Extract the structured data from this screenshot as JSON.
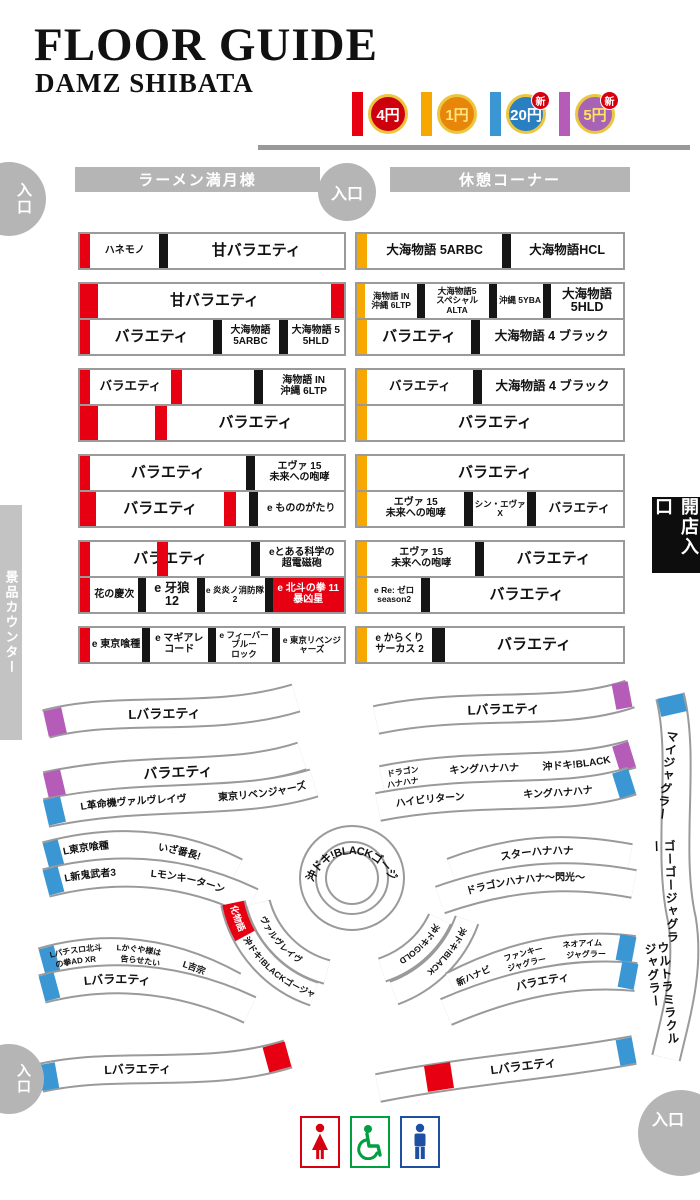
{
  "header": {
    "title": "FLOOR GUIDE",
    "subtitle": "DAMZ SHIBATA"
  },
  "legend": {
    "items": [
      {
        "bar": "#e60012",
        "coin_bg": "#cf000e",
        "coin_fg": "#ffffff",
        "label": "4円",
        "new_badge": ""
      },
      {
        "bar": "#f6a800",
        "coin_bg": "#e8860a",
        "coin_fg": "#ffe480",
        "label": "1円",
        "new_badge": ""
      },
      {
        "bar": "#3b97d3",
        "coin_bg": "#2a7fc0",
        "coin_fg": "#ffffff",
        "label": "20円",
        "new_badge": "新"
      },
      {
        "bar": "#b45cb8",
        "coin_bg": "#a763b5",
        "coin_fg": "#ffe45c",
        "label": "5円",
        "new_badge": "新"
      }
    ]
  },
  "zones": {
    "ramen": "ラーメン満月様",
    "rest": "休憩コーナー",
    "prize": "景品カウンター",
    "open": "開店入口"
  },
  "entrances": {
    "top_left": "入口",
    "top_mid": "入口",
    "bottom_left": "入口",
    "bottom_right": "入口"
  },
  "jagglers": [
    "マイジャグラー",
    "ゴーゴージャグラー",
    "ウルトラミラクルジャグラー"
  ],
  "restroom_icons": [
    "woman-icon",
    "wheelchair-icon",
    "man-icon"
  ],
  "grid": {
    "left": [
      {
        "rows": [
          [
            {
              "bar": "#e60012",
              "px": 10
            },
            {
              "t": "ハネモノ",
              "sz": "s",
              "w": 0.95
            },
            {
              "blk": 9
            },
            {
              "t": "甘バラエティ",
              "sz": "l",
              "w": 2.4
            }
          ]
        ]
      },
      {
        "rows": [
          [
            {
              "bar": "#e60012",
              "px": 18
            },
            {
              "t": "甘バラエティ",
              "sz": "l",
              "w": 1
            },
            {
              "bar": "#e60012",
              "px": 13
            }
          ],
          [
            {
              "bar": "#e60012",
              "px": 10
            },
            {
              "t": "バラエティ",
              "sz": "l",
              "w": 1.75
            },
            {
              "blk": 9
            },
            {
              "t": "大海物語\n5ARBC",
              "sz": "s",
              "w": 0.8
            },
            {
              "blk": 9
            },
            {
              "t": "大海物語 5\n5HLD",
              "sz": "s",
              "w": 0.8
            }
          ]
        ]
      },
      {
        "rows": [
          [
            {
              "bar": "#e60012",
              "px": 10
            },
            {
              "t": "バラエティ",
              "sz": "m",
              "w": 1
            },
            {
              "bar": "#e60012",
              "px": 11
            },
            {
              "t": "",
              "sz": "m",
              "w": 0.9
            },
            {
              "blk": 9
            },
            {
              "t": "海物語 IN\n沖縄 6LTP",
              "sz": "s",
              "w": 1
            }
          ],
          [
            {
              "bar": "#e60012",
              "px": 18
            },
            {
              "t": "",
              "sz": "m",
              "w": 0.55
            },
            {
              "bar": "#e60012",
              "px": 12
            },
            {
              "t": "バラエティ",
              "sz": "l",
              "w": 1.7
            }
          ]
        ]
      },
      {
        "rows": [
          [
            {
              "bar": "#e60012",
              "px": 10
            },
            {
              "t": "バラエティ",
              "sz": "l",
              "w": 1.75
            },
            {
              "blk": 9
            },
            {
              "t": "エヴァ 15\n未来への咆哮",
              "sz": "s",
              "w": 1
            }
          ],
          [
            {
              "bar": "#e60012",
              "px": 16
            },
            {
              "t": "バラエティ",
              "sz": "l",
              "w": 1.5
            },
            {
              "bar": "#e60012",
              "px": 12
            },
            {
              "t": "",
              "sz": "m",
              "w": 0.15
            },
            {
              "blk": 9
            },
            {
              "t": "e もののがたり",
              "sz": "s",
              "w": 1
            }
          ]
        ]
      },
      {
        "rows": [
          [
            {
              "bar": "#e60012",
              "px": 10
            },
            {
              "t": "バラエティ",
              "sz": "l",
              "w": 1.9,
              "stripe": 42
            },
            {
              "blk": 9
            },
            {
              "t": "eとある科学の\n超電磁砲",
              "sz": "s",
              "w": 1
            }
          ],
          [
            {
              "bar": "#e60012",
              "px": 10
            },
            {
              "t": "花の慶次",
              "sz": "s",
              "w": 0.78
            },
            {
              "blk": 8
            },
            {
              "t": "e 牙狼 12",
              "sz": "m",
              "w": 0.82
            },
            {
              "blk": 8
            },
            {
              "t": "e 炎炎ノ消防隊 2",
              "sz": "t",
              "w": 0.95
            },
            {
              "blk": 8
            },
            {
              "t": "e 北斗の拳 11\n暴凶星",
              "sz": "s",
              "w": 1.15,
              "red": true
            }
          ]
        ]
      },
      {
        "rows": [
          [
            {
              "bar": "#e60012",
              "px": 10
            },
            {
              "t": "e 東京喰種",
              "sz": "s",
              "w": 0.85
            },
            {
              "blk": 8
            },
            {
              "t": "e マギアレコード",
              "sz": "s",
              "w": 0.95
            },
            {
              "blk": 8
            },
            {
              "t": "e フィーバーブルー\nロック",
              "sz": "t",
              "w": 0.9
            },
            {
              "blk": 8
            },
            {
              "t": "e 東京リベンジャーズ",
              "sz": "t",
              "w": 1.05
            }
          ]
        ]
      }
    ],
    "right": [
      {
        "rows": [
          [
            {
              "bar": "#f6a800",
              "px": 10
            },
            {
              "t": "大海物語 5ARBC",
              "sz": "m",
              "w": 1.15
            },
            {
              "blk": 9
            },
            {
              "t": "大海物語HCL",
              "sz": "m",
              "w": 0.95
            }
          ]
        ]
      },
      {
        "rows": [
          [
            {
              "bar": "#f6a800",
              "px": 8
            },
            {
              "t": "海物語 IN\n沖縄 6LTP",
              "sz": "t",
              "w": 0.62
            },
            {
              "blk": 8
            },
            {
              "t": "大海物語5\nスペシャル ALTA",
              "sz": "t",
              "w": 0.75
            },
            {
              "blk": 8
            },
            {
              "t": "沖縄 5YBA",
              "sz": "t",
              "w": 0.55
            },
            {
              "blk": 8
            },
            {
              "t": "大海物語\n5HLD",
              "sz": "m",
              "w": 0.85
            }
          ],
          [
            {
              "bar": "#f6a800",
              "px": 10
            },
            {
              "t": "バラエティ",
              "sz": "l",
              "w": 0.95
            },
            {
              "blk": 9
            },
            {
              "t": "大海物語 4 ブラック",
              "sz": "m",
              "w": 1.3
            }
          ]
        ]
      },
      {
        "rows": [
          [
            {
              "bar": "#f6a800",
              "px": 10
            },
            {
              "t": "バラエティ",
              "sz": "m",
              "w": 0.9
            },
            {
              "blk": 9
            },
            {
              "t": "大海物語 4 ブラック",
              "sz": "m",
              "w": 1.2
            }
          ],
          [
            {
              "bar": "#f6a800",
              "px": 10
            },
            {
              "t": "バラエティ",
              "sz": "l",
              "w": 1
            }
          ]
        ]
      },
      {
        "rows": [
          [
            {
              "bar": "#f6a800",
              "px": 10
            },
            {
              "t": "バラエティ",
              "sz": "l",
              "w": 1
            }
          ],
          [
            {
              "bar": "#f6a800",
              "px": 10
            },
            {
              "t": "エヴァ 15\n未来への咆哮",
              "sz": "s",
              "w": 0.95
            },
            {
              "blk": 9
            },
            {
              "t": "シン・エヴァ X",
              "sz": "t",
              "w": 0.52
            },
            {
              "blk": 9
            },
            {
              "t": "バラエティ",
              "sz": "m",
              "w": 0.85
            }
          ]
        ]
      },
      {
        "rows": [
          [
            {
              "bar": "#f6a800",
              "px": 10
            },
            {
              "t": "エヴァ 15\n未来への咆哮",
              "sz": "s",
              "w": 0.9
            },
            {
              "blk": 9
            },
            {
              "t": "バラエティ",
              "sz": "l",
              "w": 1.15
            }
          ],
          [
            {
              "bar": "#f6a800",
              "px": 10
            },
            {
              "t": "e Re: ゼロ\nseason2",
              "sz": "t",
              "w": 0.45
            },
            {
              "blk": 9
            },
            {
              "t": "バラエティ",
              "sz": "l",
              "w": 1.6
            }
          ]
        ]
      },
      {
        "rows": [
          [
            {
              "bar": "#f6a800",
              "px": 10
            },
            {
              "t": "e からくり\nサーカス 2",
              "sz": "s",
              "w": 0.55
            },
            {
              "blk": 13
            },
            {
              "t": "バラエティ",
              "sz": "l",
              "w": 1.5
            }
          ]
        ]
      }
    ]
  },
  "bands": [
    {
      "id": "bl1",
      "d": "M46,44 C120,24 210,44 296,18",
      "w": 26,
      "caps": [
        {
          "d": "M46,44 L64,40",
          "c": "#b45cb8"
        }
      ],
      "labels": [
        {
          "t": "Lバラエティ",
          "off": "33%",
          "s": 13
        }
      ]
    },
    {
      "id": "br1",
      "d": "M376,40 C470,20 560,38 630,14",
      "w": 26,
      "caps": [
        {
          "d": "M614,17 L630,14",
          "c": "#b45cb8"
        }
      ],
      "labels": [
        {
          "t": "Lバラエティ",
          "off": "36%",
          "s": 13
        }
      ]
    },
    {
      "id": "bl2a",
      "d": "M46,106 C150,84 230,100 302,76",
      "w": 26,
      "caps": [
        {
          "d": "M46,106 L63,102",
          "c": "#b45cb8"
        }
      ],
      "labels": [
        {
          "t": "バラエティ",
          "off": "38%",
          "s": 14
        }
      ]
    },
    {
      "id": "bl2b",
      "d": "M46,133 C150,111 235,127 314,103",
      "w": 26,
      "caps": [
        {
          "d": "M46,133 L63,129",
          "c": "#3b97d3"
        }
      ],
      "labels": [
        {
          "t": "L革命機ヴァルヴレイヴ",
          "off": "13%",
          "s": 10
        },
        {
          "t": "東京リベンジャーズ",
          "off": "64%",
          "s": 10
        }
      ]
    },
    {
      "id": "br2a",
      "d": "M382,100 C480,80 560,96 632,74",
      "w": 26,
      "caps": [
        {
          "d": "M616,79 L632,74",
          "c": "#b45cb8"
        }
      ],
      "labels": [
        {
          "t": "キングハナハナ",
          "off": "27%",
          "s": 10
        },
        {
          "t": "沖ドキ!BLACK",
          "off": "64%",
          "s": 10
        }
      ]
    },
    {
      "id": "br2a1",
      "d": "M382,95 C480,75 560,91 632,69",
      "w": 0,
      "labels": [
        {
          "t": "ドラゴン",
          "off": "2%",
          "s": 8
        }
      ]
    },
    {
      "id": "br2a2",
      "d": "M382,106 C480,86 560,102 632,80",
      "w": 0,
      "labels": [
        {
          "t": "ハナハナ",
          "off": "2%",
          "s": 8
        }
      ]
    },
    {
      "id": "br2b",
      "d": "M378,127 C480,107 565,123 632,101",
      "w": 26,
      "caps": [
        {
          "d": "M616,106 L632,101",
          "c": "#3b97d3"
        }
      ],
      "labels": [
        {
          "t": "ハイビリターン",
          "off": "7%",
          "s": 10
        },
        {
          "t": "キングハナハナ",
          "off": "57%",
          "s": 10
        }
      ]
    },
    {
      "id": "bl3a",
      "d": "M46,176 Q150,148 236,192",
      "w": 26,
      "caps": [
        {
          "d": "M46,176 L61,172",
          "c": "#3b97d3"
        }
      ],
      "labels": [
        {
          "t": "L東京喰種",
          "off": "9%",
          "s": 10
        },
        {
          "t": "いざ番長!",
          "off": "58%",
          "s": 10
        }
      ]
    },
    {
      "id": "bl3b",
      "d": "M46,203 Q155,175 252,222",
      "w": 26,
      "caps": [
        {
          "d": "M46,203 L61,199",
          "c": "#3b97d3"
        }
      ],
      "labels": [
        {
          "t": "L新鬼武者3",
          "off": "9%",
          "s": 10
        },
        {
          "t": "Lモンキーターン",
          "off": "50%",
          "s": 10
        }
      ]
    },
    {
      "id": "br3a",
      "d": "M452,192 C520,166 575,168 630,178",
      "w": 26,
      "labels": [
        {
          "t": "スターハナハナ",
          "off": "28%",
          "s": 10.5
        }
      ]
    },
    {
      "id": "br3b",
      "d": "M440,220 C520,192 580,194 634,204",
      "w": 26,
      "labels": [
        {
          "t": "ドラゴンハナハナ〜閃光〜",
          "off": "14%",
          "s": 10
        }
      ]
    },
    {
      "id": "ringtext",
      "d": "M310,202 A44,44 0 0 1 394,202",
      "w": 0,
      "labels": [
        {
          "t": "沖ドキ!BLACKゴージャス",
          "off": "1%",
          "s": 11
        }
      ]
    },
    {
      "id": "swo",
      "d": "M233,223 A122,122 0 0 0 314,314",
      "w": 22,
      "caps": [
        {
          "d": "M233,223 A122,122 0 0 0 245,256",
          "c": "#e60012"
        }
      ],
      "labels": [
        {
          "t": "化物語",
          "off": "2%",
          "s": 9,
          "fill": "#fff"
        },
        {
          "t": "沖ドキ!BLACKゴージャス",
          "off": "29%",
          "s": 8.5
        }
      ]
    },
    {
      "id": "swi",
      "d": "M258,223 A97,97 0 0 0 327,292",
      "w": 22,
      "labels": [
        {
          "t": "ヴァルヴレイヴ",
          "off": "14%",
          "s": 8.5
        }
      ]
    },
    {
      "id": "seo",
      "d": "M467,240 A122,122 0 0 1 394,313",
      "w": 22,
      "labels": [
        {
          "t": "沖ドキ!BLACK",
          "off": "8%",
          "s": 8.5
        }
      ]
    },
    {
      "id": "sei",
      "d": "M440,239 A97,97 0 0 1 382,290",
      "w": 22,
      "labels": [
        {
          "t": "沖ドキ!GOLD",
          "off": "8%",
          "s": 8.5
        }
      ]
    },
    {
      "id": "bbla",
      "d": "M42,282 Q140,254 234,306",
      "w": 26,
      "caps": [
        {
          "d": "M42,282 L57,278",
          "c": "#3b97d3"
        }
      ],
      "labels": [
        {
          "t": "L吉宗",
          "off": "72%",
          "s": 9
        }
      ]
    },
    {
      "id": "bbla1",
      "d": "M42,277 Q140,249 234,301",
      "w": 0,
      "labels": [
        {
          "t": "Lパチスロ北斗",
          "off": "4%",
          "s": 8
        },
        {
          "t": "Lかぐや様は",
          "off": "38%",
          "s": 8
        }
      ]
    },
    {
      "id": "bbla2",
      "d": "M42,288 Q140,260 234,312",
      "w": 0,
      "labels": [
        {
          "t": "の拳AD XR",
          "off": "7%",
          "s": 8
        },
        {
          "t": "告らせたい",
          "off": "40%",
          "s": 8
        }
      ]
    },
    {
      "id": "bblb",
      "d": "M42,309 Q148,282 250,330",
      "w": 26,
      "caps": [
        {
          "d": "M42,309 L57,305",
          "c": "#3b97d3"
        }
      ],
      "labels": [
        {
          "t": "Lバラエティ",
          "off": "20%",
          "s": 12
        }
      ]
    },
    {
      "id": "bbra",
      "d": "M452,306 Q545,258 634,270",
      "w": 26,
      "caps": [
        {
          "d": "M618,267 L634,270",
          "c": "#3b97d3"
        }
      ],
      "labels": [
        {
          "t": "新ハナビ",
          "off": "3%",
          "s": 9
        }
      ]
    },
    {
      "id": "bbra1",
      "d": "M452,301 Q545,253 634,265",
      "w": 0,
      "labels": [
        {
          "t": "ファンキー",
          "off": "30%",
          "s": 8
        },
        {
          "t": "ネオアイム",
          "off": "62%",
          "s": 8
        }
      ]
    },
    {
      "id": "bbra2",
      "d": "M452,312 Q545,264 634,276",
      "w": 0,
      "labels": [
        {
          "t": "ジャグラー",
          "off": "32%",
          "s": 8
        },
        {
          "t": "ジャグラー",
          "off": "64%",
          "s": 8
        }
      ]
    },
    {
      "id": "bbrb",
      "d": "M446,332 Q548,288 636,297",
      "w": 26,
      "caps": [
        {
          "d": "M620,294 L636,297",
          "c": "#3b97d3"
        }
      ],
      "labels": [
        {
          "t": "バラエティ",
          "off": "38%",
          "s": 11
        }
      ]
    },
    {
      "id": "bsl",
      "d": "M40,398 C120,380 205,400 288,374",
      "w": 26,
      "caps": [
        {
          "d": "M40,398 L57,395",
          "c": "#3b97d3"
        },
        {
          "d": "M266,380 L288,374",
          "c": "#e60012"
        }
      ],
      "labels": [
        {
          "t": "Lバラエティ",
          "off": "26%",
          "s": 12
        }
      ]
    },
    {
      "id": "bsr",
      "d": "M378,408 C470,390 545,386 634,370",
      "w": 26,
      "caps": [
        {
          "d": "M618,373 L634,370",
          "c": "#3b97d3"
        },
        {
          "d": "M426,399 L452,395",
          "c": "#e60012"
        }
      ],
      "labels": [
        {
          "t": "Lバラエティ",
          "off": "44%",
          "s": 12
        }
      ]
    },
    {
      "id": "jag",
      "d": "M670,16 C686,80 666,170 682,240 C690,290 676,335 666,378",
      "w": 26,
      "caps": [
        {
          "d": "M670,16 L674,34",
          "c": "#3b97d3"
        }
      ],
      "labels": []
    }
  ]
}
